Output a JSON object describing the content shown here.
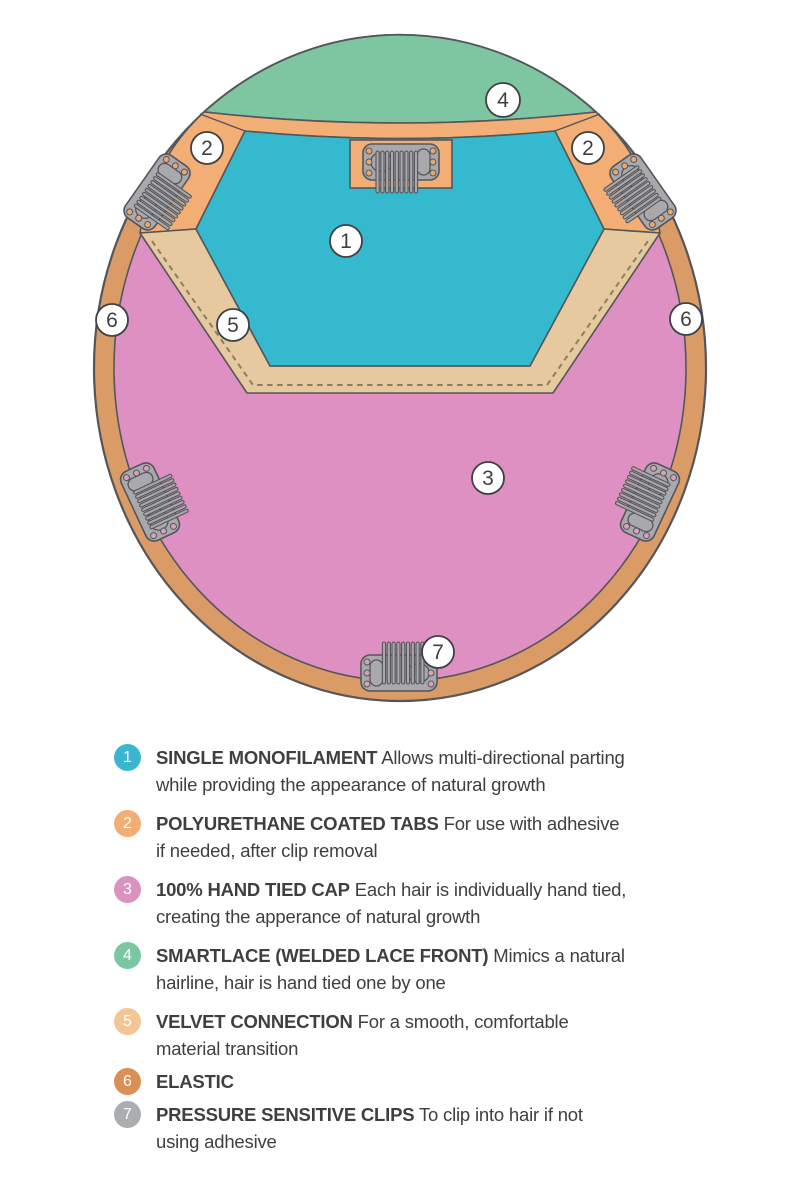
{
  "colors": {
    "monofilament_blue": "#35B9CF",
    "tab_orange": "#F2AE74",
    "hand_tied_pink": "#DE90C3",
    "smartlace_green": "#7EC6A1",
    "velvet_tan": "#E6C99E",
    "elastic_orange": "#DB9B66",
    "clip_gray": "#A9A9AD",
    "outline_gray": "#55565A",
    "text_color": "#3F3F41"
  },
  "diagram": {
    "callouts": [
      {
        "label": "1"
      },
      {
        "label": "2"
      },
      {
        "label": "2"
      },
      {
        "label": "3"
      },
      {
        "label": "4"
      },
      {
        "label": "5"
      },
      {
        "label": "6"
      },
      {
        "label": "6"
      },
      {
        "label": "7"
      }
    ]
  },
  "legend": {
    "items": [
      {
        "num": "1",
        "label": "SINGLE MONOFILAMENT",
        "desc": " Allows multi-directional parting\nwhile providing the appearance of natural growth",
        "color": "#3CB6CF"
      },
      {
        "num": "2",
        "label": "POLYURETHANE COATED TABS",
        "desc": " For use with adhesive\nif needed, after clip removal",
        "color": "#F3AE74"
      },
      {
        "num": "3",
        "label": "100% HAND TIED CAP",
        "desc": " Each hair is individually hand tied,\ncreating the apperance of natural growth",
        "color": "#D893BE"
      },
      {
        "num": "4",
        "label": "SMARTLACE (WELDED LACE FRONT)",
        "desc": " Mimics a natural\nhairline, hair is hand tied one by one",
        "color": "#7CC7A2"
      },
      {
        "num": "5",
        "label": "VELVET CONNECTION",
        "desc": " For a smooth, comfortable\nmaterial transition",
        "color": "#F2C795"
      },
      {
        "num": "6",
        "label": "ELASTIC",
        "desc": "",
        "color": "#D98F55"
      },
      {
        "num": "7",
        "label": "PRESSURE SENSITIVE CLIPS",
        "desc": " To clip into hair if not\nusing adhesive",
        "color": "#ABADB0"
      }
    ]
  }
}
